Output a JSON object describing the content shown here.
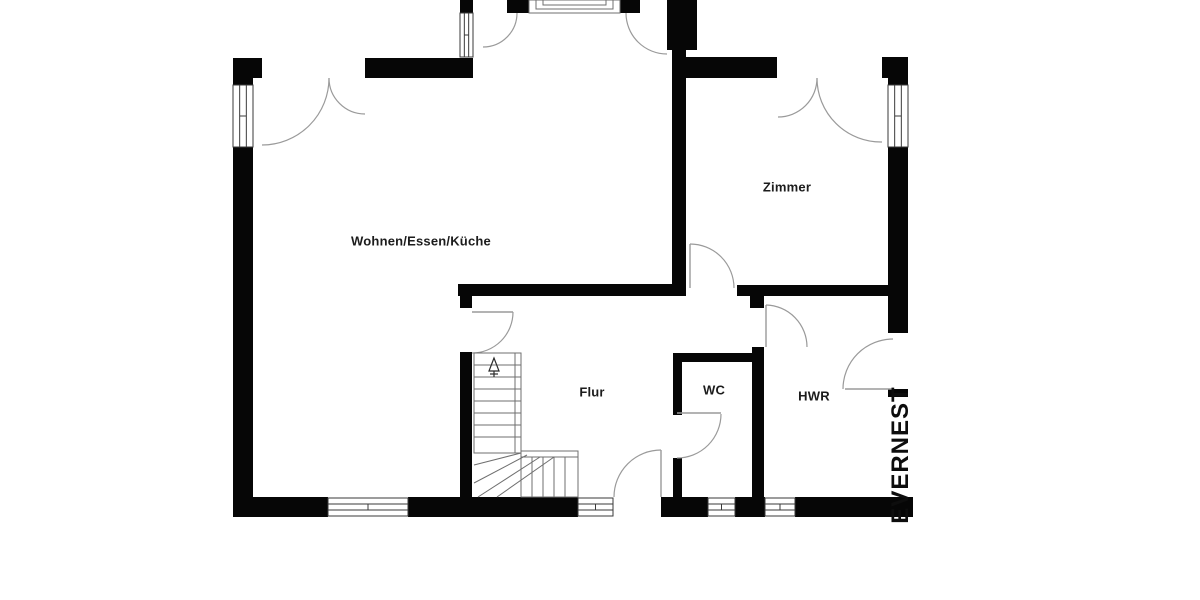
{
  "meta": {
    "type": "floor-plan",
    "background": "#ffffff",
    "wall_color": "#060606",
    "swing_color": "#9a9a9a",
    "detail_color": "#6f6f6f",
    "label_color": "#1c1c1c"
  },
  "watermark": {
    "label": "EVERNEST",
    "cx": 901,
    "cy": 455
  },
  "rooms": [
    {
      "id": "wohnen",
      "label": "Wohnen/Essen/Küche",
      "cx": 421,
      "cy": 241
    },
    {
      "id": "zimmer",
      "label": "Zimmer",
      "cx": 787,
      "cy": 187
    },
    {
      "id": "flur",
      "label": "Flur",
      "cx": 592,
      "cy": 392
    },
    {
      "id": "wc",
      "label": "WC",
      "cx": 714,
      "cy": 390
    },
    {
      "id": "hwr",
      "label": "HWR",
      "cx": 814,
      "cy": 396
    }
  ],
  "plan": {
    "walls": [
      [
        233,
        58,
        29,
        20
      ],
      [
        365,
        58,
        108,
        20
      ],
      [
        460,
        0,
        13,
        13
      ],
      [
        507,
        0,
        22,
        13
      ],
      [
        620,
        0,
        20,
        13
      ],
      [
        667,
        0,
        30,
        50
      ],
      [
        680,
        57,
        97,
        21
      ],
      [
        882,
        57,
        26,
        21
      ],
      [
        233,
        78,
        20,
        7
      ],
      [
        233,
        147,
        20,
        370
      ],
      [
        888,
        78,
        20,
        7
      ],
      [
        888,
        147,
        20,
        186
      ],
      [
        888,
        389,
        20,
        8
      ],
      [
        888,
        497,
        25,
        20
      ],
      [
        233,
        497,
        95,
        20
      ],
      [
        408,
        497,
        170,
        20
      ],
      [
        661,
        497,
        47,
        20
      ],
      [
        735,
        497,
        30,
        20
      ],
      [
        795,
        497,
        93,
        20
      ],
      [
        672,
        50,
        14,
        246
      ],
      [
        458,
        284,
        215,
        12
      ],
      [
        737,
        285,
        151,
        11
      ],
      [
        460,
        284,
        12,
        24
      ],
      [
        460,
        352,
        12,
        145
      ],
      [
        750,
        296,
        14,
        12
      ],
      [
        752,
        347,
        12,
        150
      ],
      [
        673,
        353,
        82,
        9
      ],
      [
        673,
        353,
        9,
        62
      ],
      [
        673,
        458,
        9,
        39
      ]
    ],
    "windows": [
      {
        "x": 233,
        "y": 85,
        "w": 20,
        "h": 62,
        "o": "v"
      },
      {
        "x": 888,
        "y": 85,
        "w": 20,
        "h": 62,
        "o": "v"
      },
      {
        "x": 460,
        "y": 13,
        "w": 13,
        "h": 44,
        "o": "v"
      },
      {
        "x": 328,
        "y": 498,
        "w": 80,
        "h": 18,
        "o": "h"
      },
      {
        "x": 578,
        "y": 498,
        "w": 35,
        "h": 18,
        "o": "h"
      },
      {
        "x": 708,
        "y": 498,
        "w": 27,
        "h": 18,
        "o": "h"
      },
      {
        "x": 765,
        "y": 498,
        "w": 30,
        "h": 18,
        "o": "h"
      }
    ],
    "door_arcs": [
      "M329,78 A67,67 0 0 1 262,145",
      "M329,78 A36,36 0 0 0 365,114",
      "M817,78 A39,39 0 0 1 778,117",
      "M817,78 A64,64 0 0 0 882,142",
      "M517,13 A34,34 0 0 1 483,47",
      "M626,13 A41,41 0 0 0 667,54",
      "M690,244 A44,44 0 0 1 734,288",
      "M766,305 A42,42 0 0 1 807,347",
      "M721,414 A44,44 0 0 1 677,458",
      "M661,450 A47,47 0 0 0 614,497",
      "M893,339 A50,50 0 0 0 843,389",
      "M513,312 A41,41 0 0 1 472,353"
    ],
    "door_leaves": [
      [
        690,
        244,
        690,
        288
      ],
      [
        766,
        305,
        766,
        347
      ],
      [
        677,
        413,
        721,
        413
      ],
      [
        661,
        450,
        661,
        497
      ],
      [
        845,
        389,
        893,
        389
      ],
      [
        472,
        312,
        513,
        312
      ]
    ],
    "porch_steps": [
      [
        529,
        0,
        91,
        13
      ],
      [
        536,
        0,
        77,
        9
      ],
      [
        543,
        0,
        63,
        5
      ]
    ],
    "stairs": {
      "boxes": [
        [
          474,
          353,
          47,
          100
        ],
        [
          521,
          451,
          57,
          46
        ]
      ],
      "tread_lines": [
        [
          474,
          365,
          521,
          365
        ],
        [
          474,
          377,
          521,
          377
        ],
        [
          474,
          389,
          521,
          389
        ],
        [
          474,
          401,
          521,
          401
        ],
        [
          474,
          413,
          521,
          413
        ],
        [
          474,
          425,
          521,
          425
        ],
        [
          474,
          437,
          521,
          437
        ],
        [
          515,
          353,
          515,
          453
        ],
        [
          521,
          457,
          578,
          457
        ],
        [
          532,
          457,
          532,
          497
        ],
        [
          543,
          457,
          543,
          497
        ],
        [
          554,
          457,
          554,
          497
        ],
        [
          565,
          457,
          565,
          497
        ],
        [
          474,
          465,
          521,
          453
        ],
        [
          474,
          483,
          527,
          455
        ],
        [
          478,
          497,
          540,
          457
        ],
        [
          497,
          497,
          554,
          457
        ]
      ],
      "arrow": {
        "head": "M494,358 L489,371 L499,371 Z",
        "stem": [
          494,
          371,
          494,
          377
        ],
        "tick": [
          490,
          374,
          498,
          374
        ]
      }
    }
  }
}
